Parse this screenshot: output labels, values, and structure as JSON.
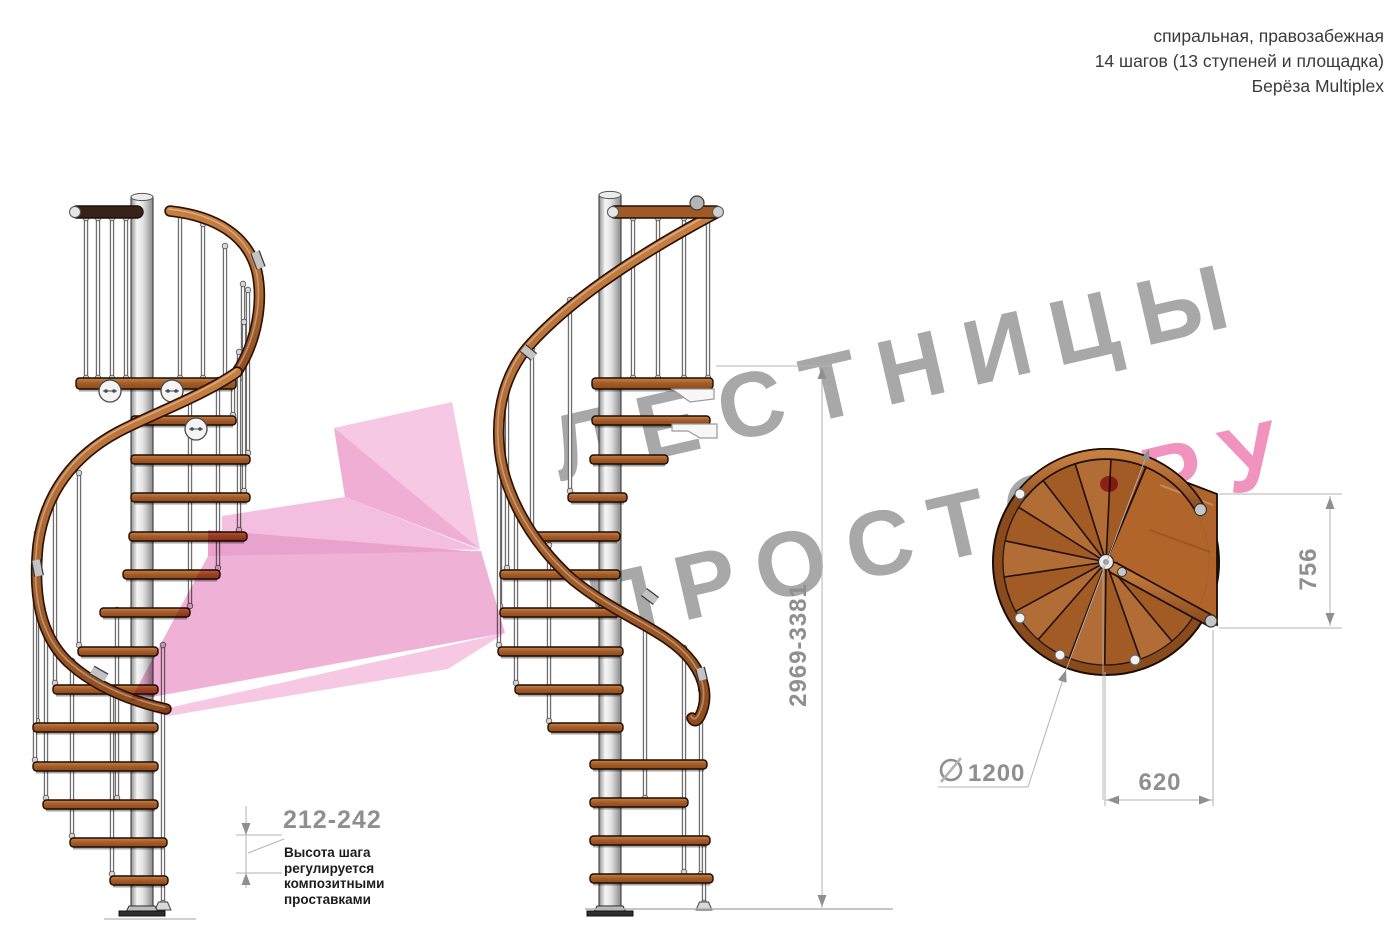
{
  "header": {
    "line1": "спиральная, правозабежная",
    "line2": "14 шагов (13 ступеней и площадка)",
    "line3": "Берёза Multiplex"
  },
  "watermark": {
    "line1": "ЛЕСТНИЦЫ",
    "line2_gray": "ПРОСТО",
    "line2_pink": ".РУ",
    "gray_color": "#a8a8a8",
    "pink_color": "#f193bf"
  },
  "annotations": {
    "step_height": "212-242",
    "step_height_note_lines": [
      "Высота шага",
      "регулируется",
      "композитными",
      "проставками"
    ],
    "total_height": "2969-3381",
    "landing_depth": "756",
    "landing_width": "620",
    "diameter_symbol": "⌀",
    "diameter_value": "1200"
  },
  "colors": {
    "wood": "#ad6127",
    "wood_dark_rim": "#8a4a1c",
    "handrail": "#b4713a",
    "pole": "#d9d9d9",
    "dimension_gray": "#8f8f8f",
    "logo_pink": "#f2b7db"
  }
}
